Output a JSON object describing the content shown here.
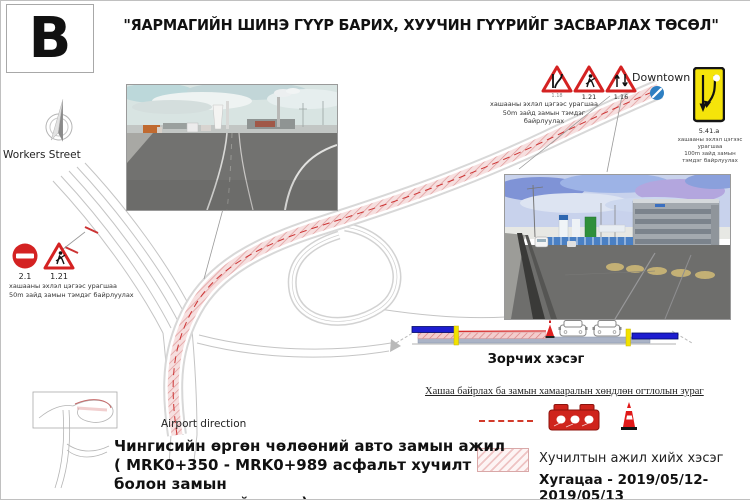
{
  "header": {
    "sheet_letter": "B",
    "title": "\"ЯАРМАГИЙН ШИНЭ ГҮҮР БАРИХ, ХУУЧИН ГҮҮРИЙГ ЗАСВАРЛАХ ТӨСӨЛ\""
  },
  "map": {
    "workers_street": "Workers Street",
    "downtown": "Downtown",
    "airport_direction": "Airport direction"
  },
  "signs": {
    "left_group": {
      "no_entry_code": "2.1",
      "roadworks_code": "1.21",
      "note_line1": "хашааны эхлэл цэгээс урагшаа",
      "note_line2": "50m зайд замын тэмдэг байрлуулах"
    },
    "top_group": {
      "narrow_code": "1.18",
      "roadworks_code": "1.21",
      "two_way_code": "1.16",
      "note_line1": "хашааны эхлэл цэгээс урагшаа",
      "note_line2": "50m зайд замын тэмдэг байрлуулах"
    },
    "lane_shift": {
      "code": "5.41.a",
      "note_line1": "хашааны эхлэл цэгээс урагшаа",
      "note_line2": "100m зайд замын тэмдэг байрлуулах"
    }
  },
  "cross_section": {
    "label": "Зорчих хэсэг"
  },
  "legend": {
    "title": "Хашаа байрлах ба замын хамааралын хөндлөн огтлолын зураг",
    "paving_area_label": "Хучилтын ажил хийх хэсэг",
    "duration": "Хугацаа - 2019/05/12-2019/05/13"
  },
  "work_note": {
    "line1": "Чингисийн өргөн чөлөөний авто замын ажил",
    "line2": "( MRK0+350 - MRK0+989 асфальт хучилт болон замын",
    "line3": "тэмдэглэгээний ажил)"
  },
  "colors": {
    "work_hatch": "#e09898",
    "closure_red": "#cc2222",
    "barrier_blue": "#1d1dd0",
    "cone_red": "#e02020",
    "sign_yellow": "#f5e40a",
    "downtown_dot": "#2e7fc2"
  }
}
